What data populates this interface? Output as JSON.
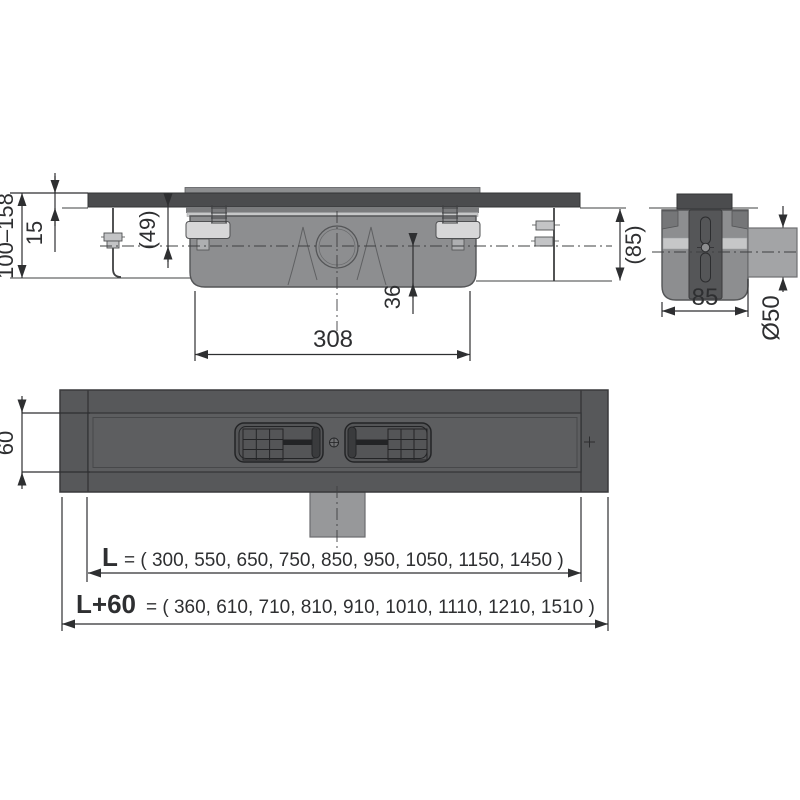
{
  "drawing_title": "shower drain channel installation drawing",
  "front_view": {
    "height_range": "100–158",
    "tile_thickness": "15",
    "depth_to_axis": "(49)",
    "axis_to_bottom": "36",
    "trap_width": "308",
    "install_depth": "(85)"
  },
  "side_view": {
    "body_width": "85",
    "pipe_diameter": "Ø50"
  },
  "plan_view": {
    "channel_width": "60",
    "length": {
      "label": "L",
      "values": "= ( 300, 550, 650, 750, 850, 950, 1050, 1150, 1450 )"
    },
    "length_plus": {
      "label": "L+60",
      "values": "= ( 360, 610, 710, 810, 910, 1010, 1110, 1210, 1510 )"
    }
  },
  "colors": {
    "body_dark": "#4b4c4e",
    "body_mid": "#8d8e90",
    "band_light": "#c6c7c8",
    "pipe_gray": "#a3a4a6",
    "channel_dark": "#57585a",
    "line_dark": "#2e2f31"
  }
}
